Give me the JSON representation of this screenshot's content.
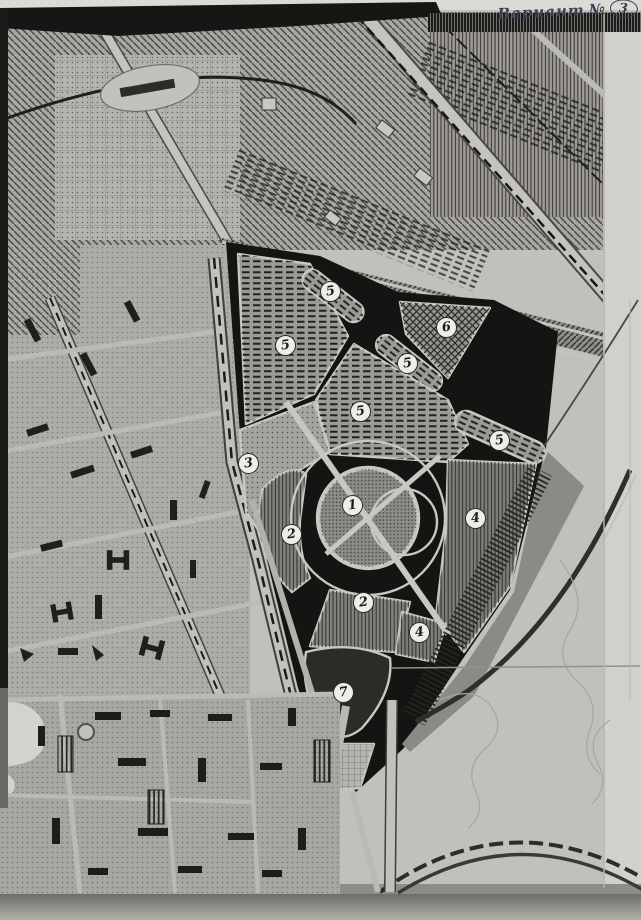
{
  "document": {
    "annotation": {
      "word": "Вариант",
      "numero": "№",
      "number": "3"
    }
  },
  "map": {
    "zone_markers": [
      {
        "num": "5",
        "x": 330,
        "y": 291
      },
      {
        "num": "6",
        "x": 446,
        "y": 327
      },
      {
        "num": "5",
        "x": 285,
        "y": 345
      },
      {
        "num": "5",
        "x": 407,
        "y": 363
      },
      {
        "num": "5",
        "x": 360,
        "y": 411
      },
      {
        "num": "5",
        "x": 499,
        "y": 440
      },
      {
        "num": "3",
        "x": 248,
        "y": 463
      },
      {
        "num": "1",
        "x": 352,
        "y": 505
      },
      {
        "num": "4",
        "x": 475,
        "y": 518
      },
      {
        "num": "2",
        "x": 291,
        "y": 534
      },
      {
        "num": "2",
        "x": 363,
        "y": 602
      },
      {
        "num": "4",
        "x": 419,
        "y": 632
      },
      {
        "num": "7",
        "x": 343,
        "y": 692
      }
    ],
    "colors": {
      "paper": "#c2c0ba",
      "paper_light": "#d2d0cb",
      "ink": "#161614",
      "annotation_ink": "#3a4051",
      "marker_fill": "#efede7"
    }
  }
}
